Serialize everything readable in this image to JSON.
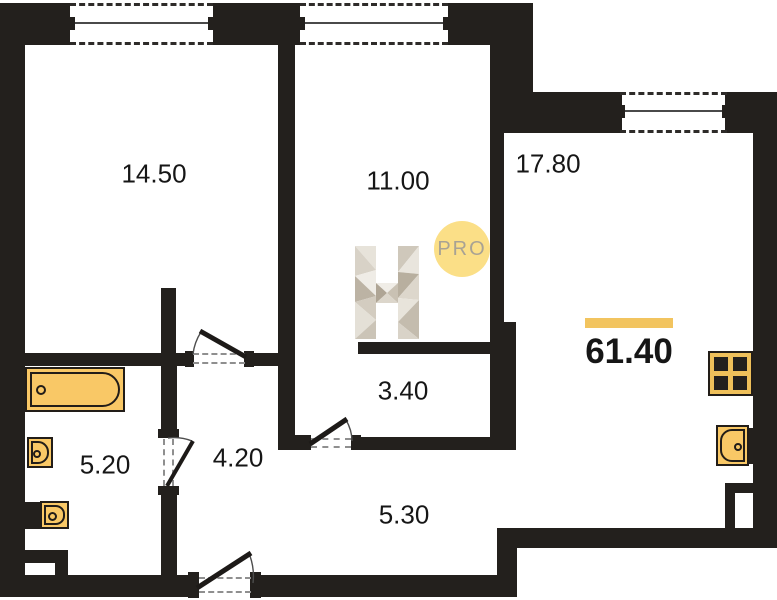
{
  "plan": {
    "rooms": [
      {
        "name": "room-14-50",
        "area": "14.50"
      },
      {
        "name": "room-11-00",
        "area": "11.00"
      },
      {
        "name": "room-17-80",
        "area": "17.80"
      },
      {
        "name": "room-3-40",
        "area": "3.40"
      },
      {
        "name": "room-4-20",
        "area": "4.20"
      },
      {
        "name": "room-5-20",
        "area": "5.20"
      },
      {
        "name": "room-5-30",
        "area": "5.30"
      }
    ],
    "total_area": "61.40",
    "badge": "PRO",
    "logo_letter": "H"
  },
  "icons": {
    "bathtub": "bathtub-icon",
    "sink": "sink-icon",
    "toilet": "toilet-icon",
    "kitchen_sink": "kitchen-sink-icon",
    "vent_shaft": "vent-shaft-icon",
    "window": "window-icon",
    "door": "door-swing-icon"
  },
  "colors": {
    "background": "#ffffff",
    "wall": "#23201d",
    "lineSolid": "#4a4a4a",
    "windowDash": "#2e2b29",
    "doorDash": "#8f8f8f",
    "doorArc": "#4d4d4d",
    "doorLeaf": "#1d1a18",
    "fixture": "#f9c866",
    "fixtureBorder": "#221d18",
    "vent": "#efc05a",
    "accentBar": "#f2c45f",
    "proCircle": "#fbdf87",
    "proText": "#a8a294",
    "label": "#161616"
  }
}
